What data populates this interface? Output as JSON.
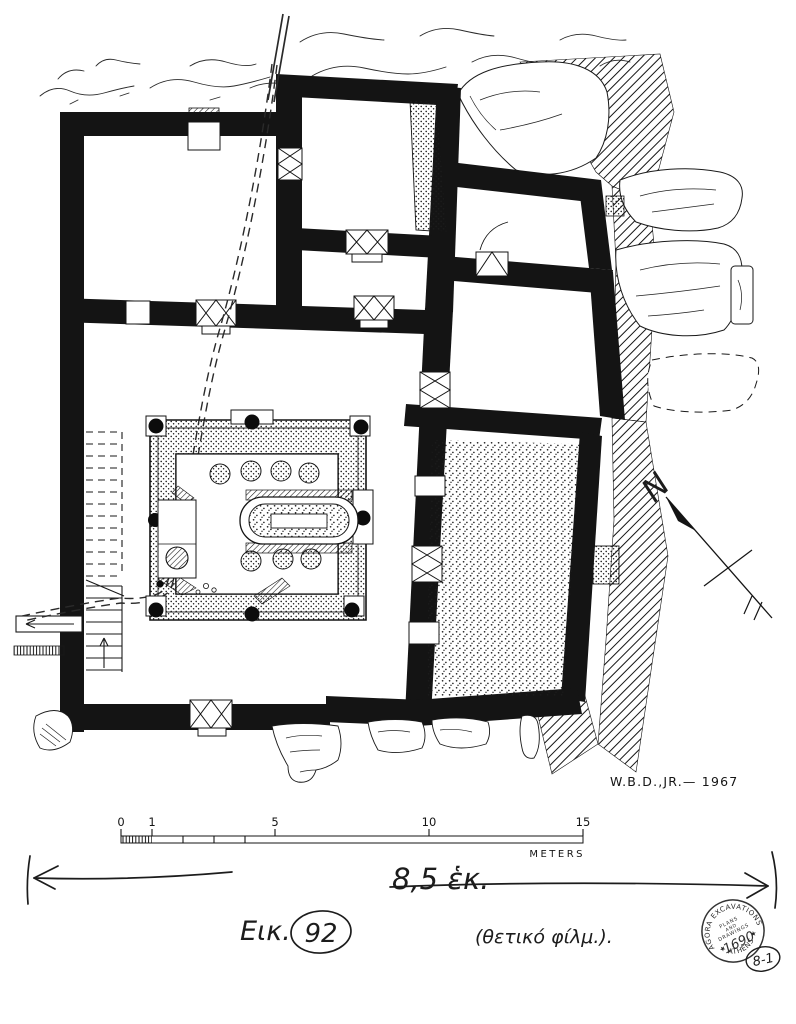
{
  "colors": {
    "ink": "#141414",
    "paper": "#ffffff",
    "pencil": "#1f1f1f"
  },
  "plan": {
    "kind": "archaeological excavation floor plan",
    "signature": "W.B.D.,JR.— 1967",
    "compass_north_label": "N"
  },
  "scale_bar": {
    "ticks": [
      "0",
      "1",
      "5",
      "10",
      "15"
    ],
    "unit": "METERS"
  },
  "annotations": {
    "dimension_text": "8,5 ἑκ.",
    "figure_prefix": "Εικ.",
    "figure_number": "92",
    "film_note": "(θετικό φίλμ.).",
    "plate_code": "8-1"
  },
  "stamp": {
    "arc_top": "AGORA EXCAVATIONS",
    "arc_bottom": "★ ATHENS ★",
    "center_lines": [
      "PLANS",
      "AND",
      "DRAWINGS"
    ],
    "number": "1690"
  }
}
